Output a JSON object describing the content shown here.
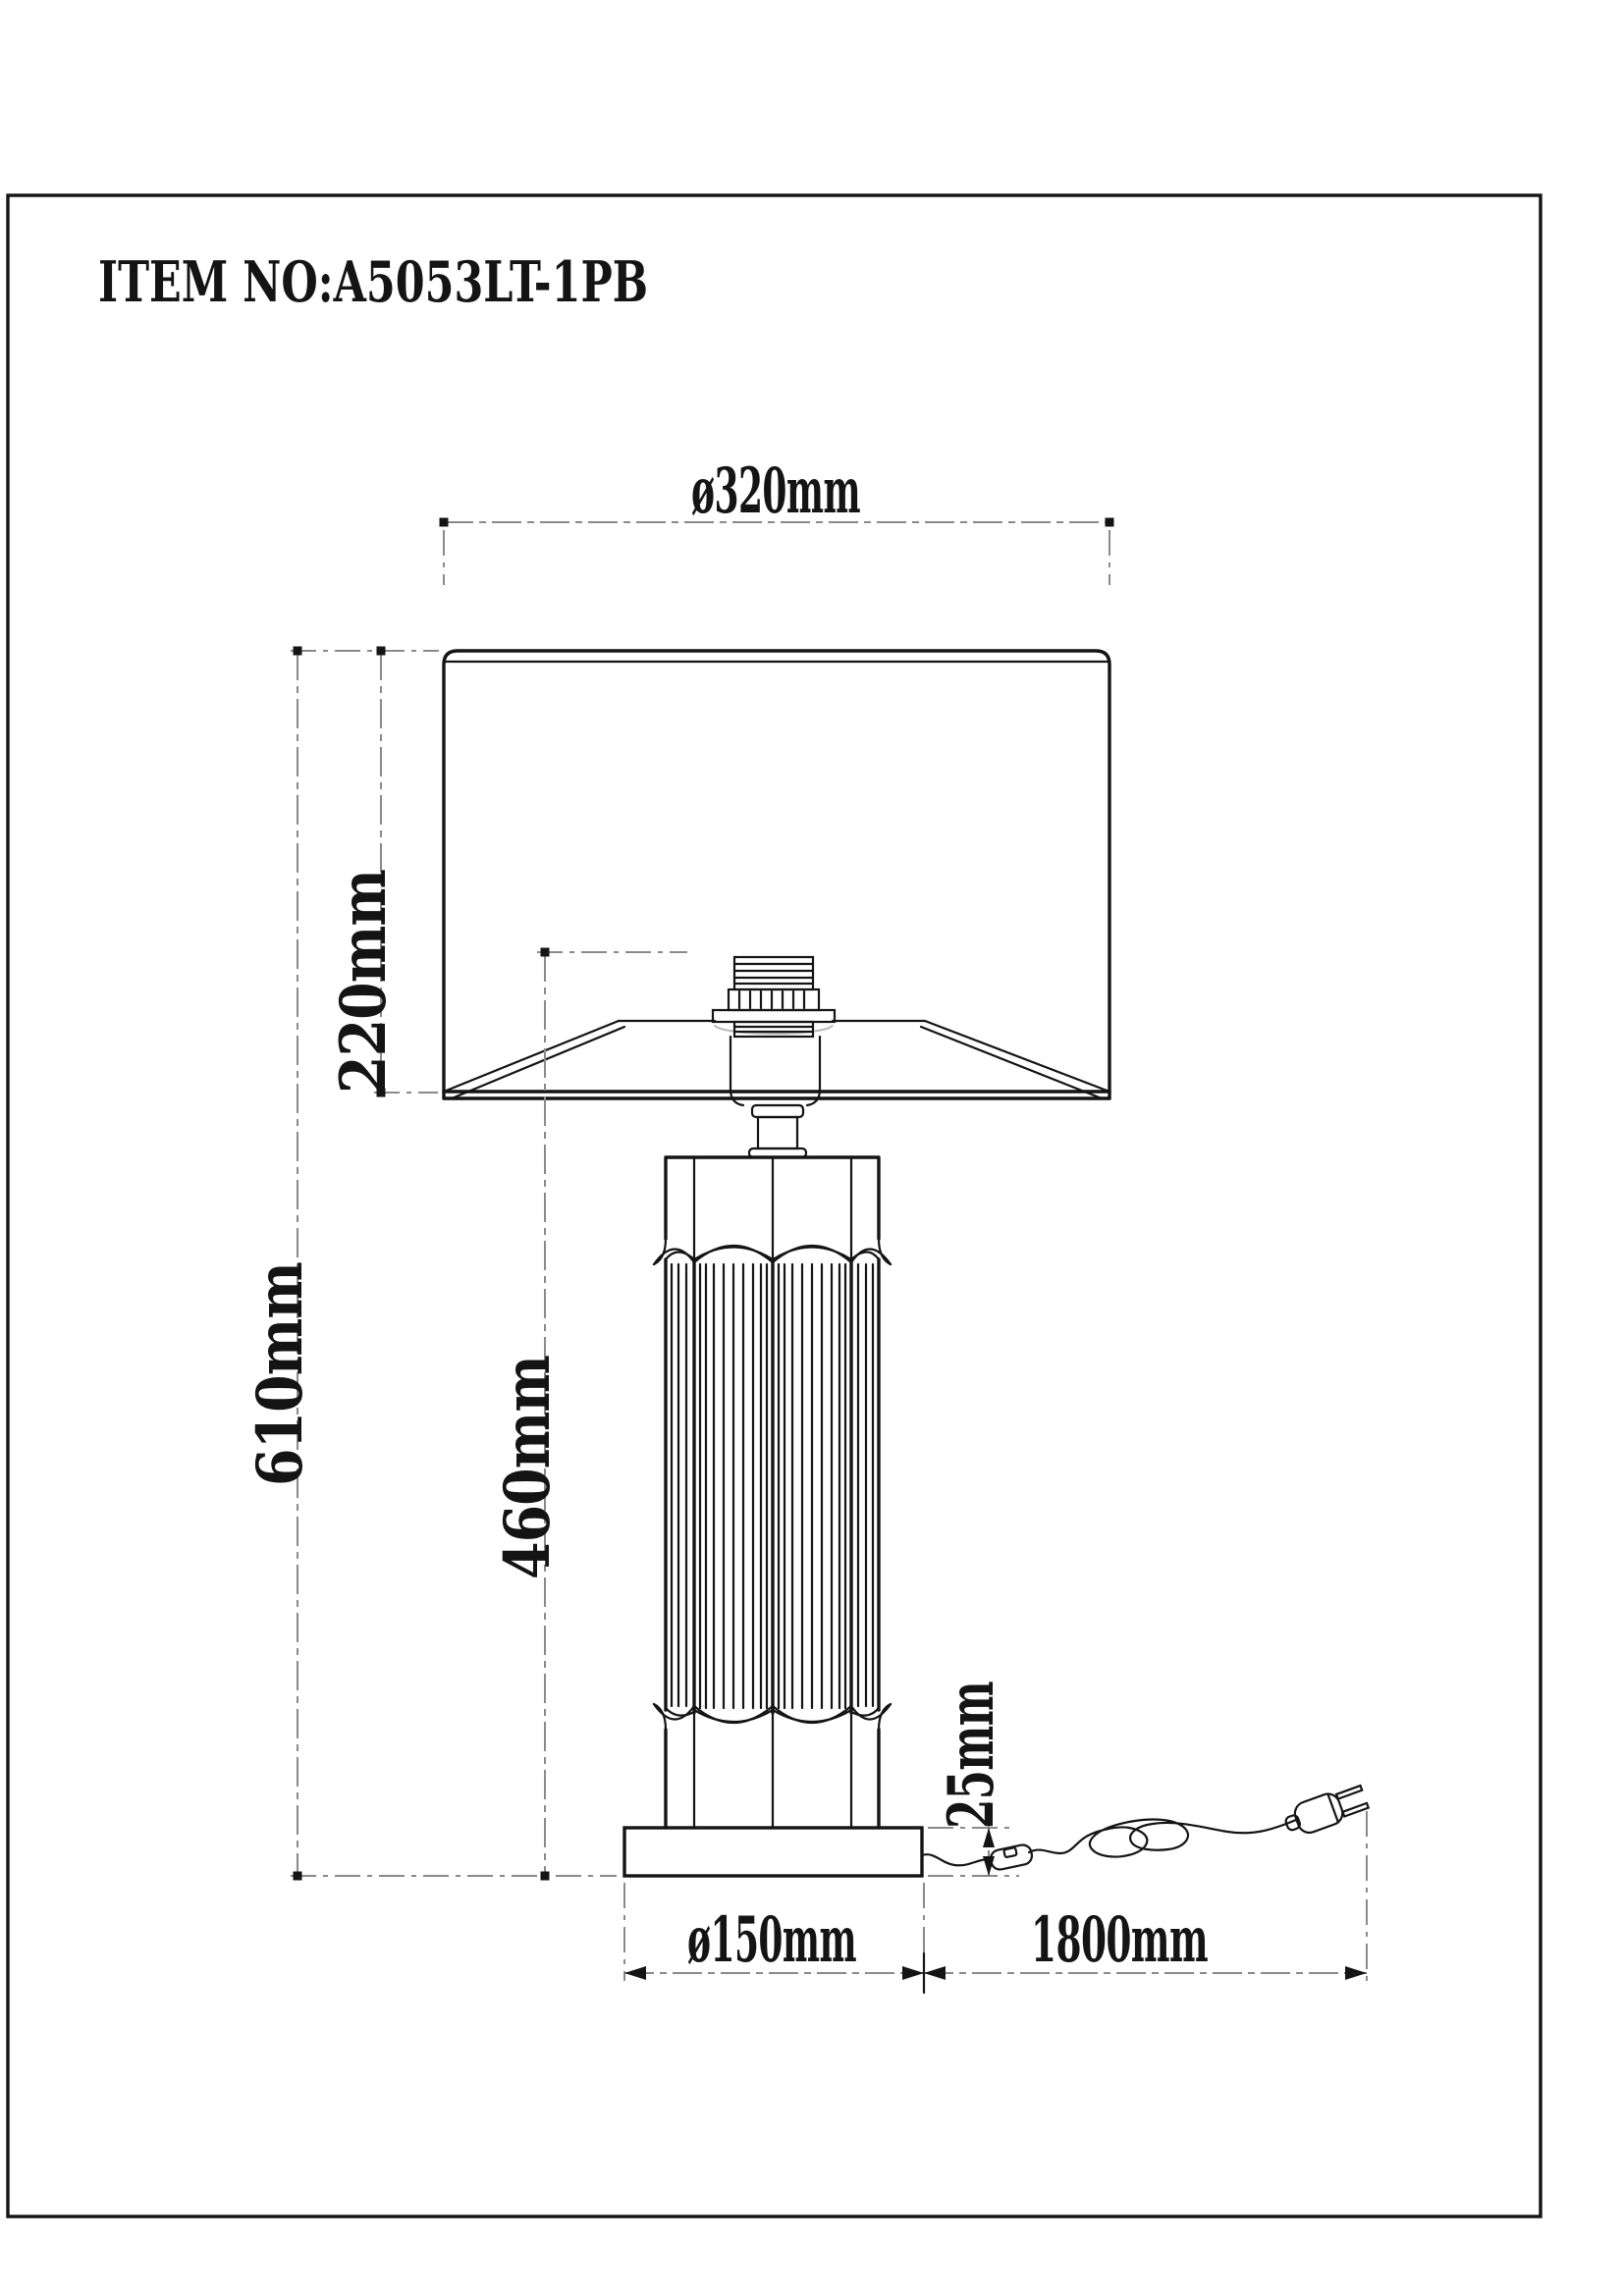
{
  "page": {
    "item_label": "ITEM NO:A5053LT-1PB"
  },
  "drawing": {
    "subject": "table-lamp-technical-drawing",
    "line_color": "#141414",
    "dimension_line_color": "#8a8a8a",
    "background_color": "#ffffff"
  },
  "dimensions": {
    "shade_diameter": {
      "label": "ø320mm",
      "value_mm": 320
    },
    "shade_height": {
      "label": "220mm",
      "value_mm": 220
    },
    "total_height": {
      "label": "610mm",
      "value_mm": 610
    },
    "body_height": {
      "label": "460mm",
      "value_mm": 460
    },
    "base_height": {
      "label": "25mm",
      "value_mm": 25
    },
    "base_diameter": {
      "label": "ø150mm",
      "value_mm": 150
    },
    "cord_length": {
      "label": "1800mm",
      "value_mm": 1800
    }
  }
}
